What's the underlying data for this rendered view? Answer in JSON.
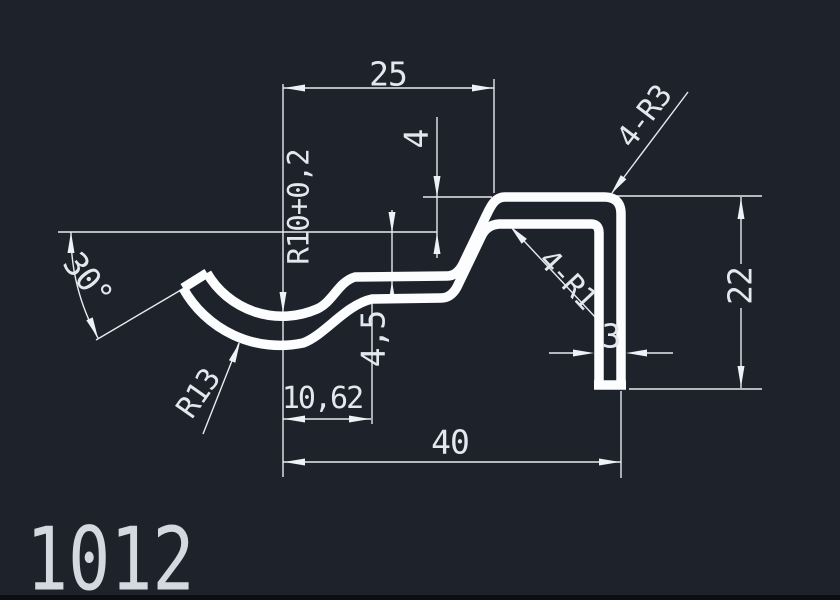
{
  "drawing": {
    "part_number": "1012",
    "background_color": "#1e222b",
    "line_color": "#e7ebef",
    "profile_color": "#fcfdfe",
    "text_color": "#e3e8ee",
    "dimensions": {
      "top_width": "25",
      "hat_drop": "4",
      "inner_radius": "R10+0,2",
      "end_angle": "30°",
      "outer_corner_radius": "4-R3",
      "right_height": "22",
      "outer_arc_radius": "R13",
      "step_depth": "4,5",
      "inner_corner_radius": "4-R1",
      "wall_thickness": "3",
      "arc_to_step_offset": "10,62",
      "total_width": "40"
    }
  }
}
